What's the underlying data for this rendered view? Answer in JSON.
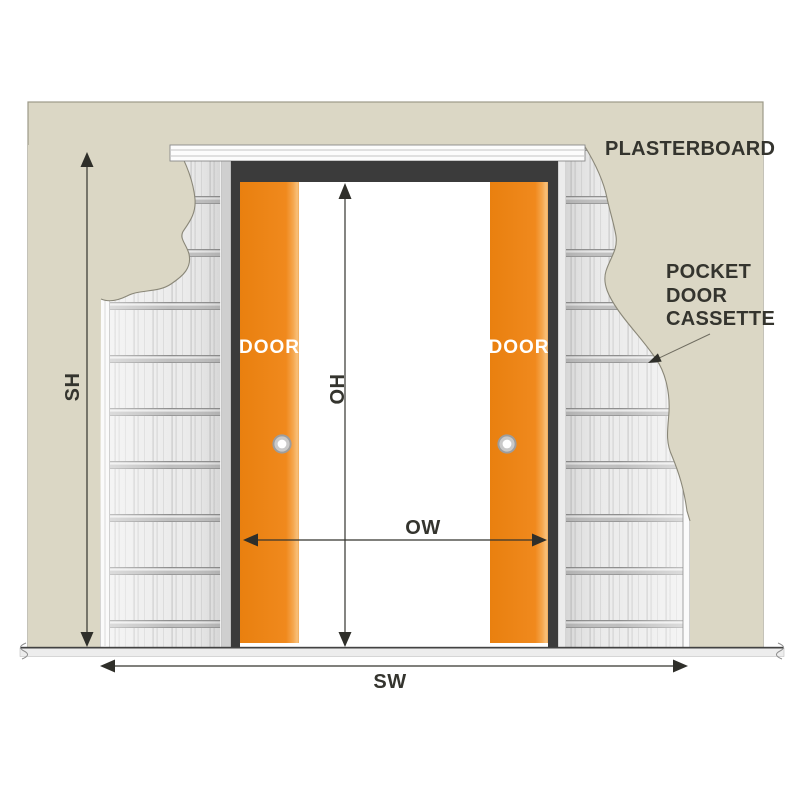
{
  "wall": {
    "label": "PLASTERBOARD",
    "color": "#dbd7c5"
  },
  "cassette_callout": {
    "line1": "POCKET",
    "line2": "DOOR",
    "line3": "CASSETTE"
  },
  "doors": {
    "left_label": "DOOR",
    "right_label": "DOOR",
    "color": "#f0891d"
  },
  "dimensions": {
    "structural_height": "SH",
    "opening_height": "OH",
    "opening_width": "OW",
    "structural_width": "SW"
  },
  "colors": {
    "frame_dark": "#3b3b3b",
    "dimension_ink": "#34342e",
    "cassette_base": "#ececec",
    "floor": "#ededed"
  }
}
